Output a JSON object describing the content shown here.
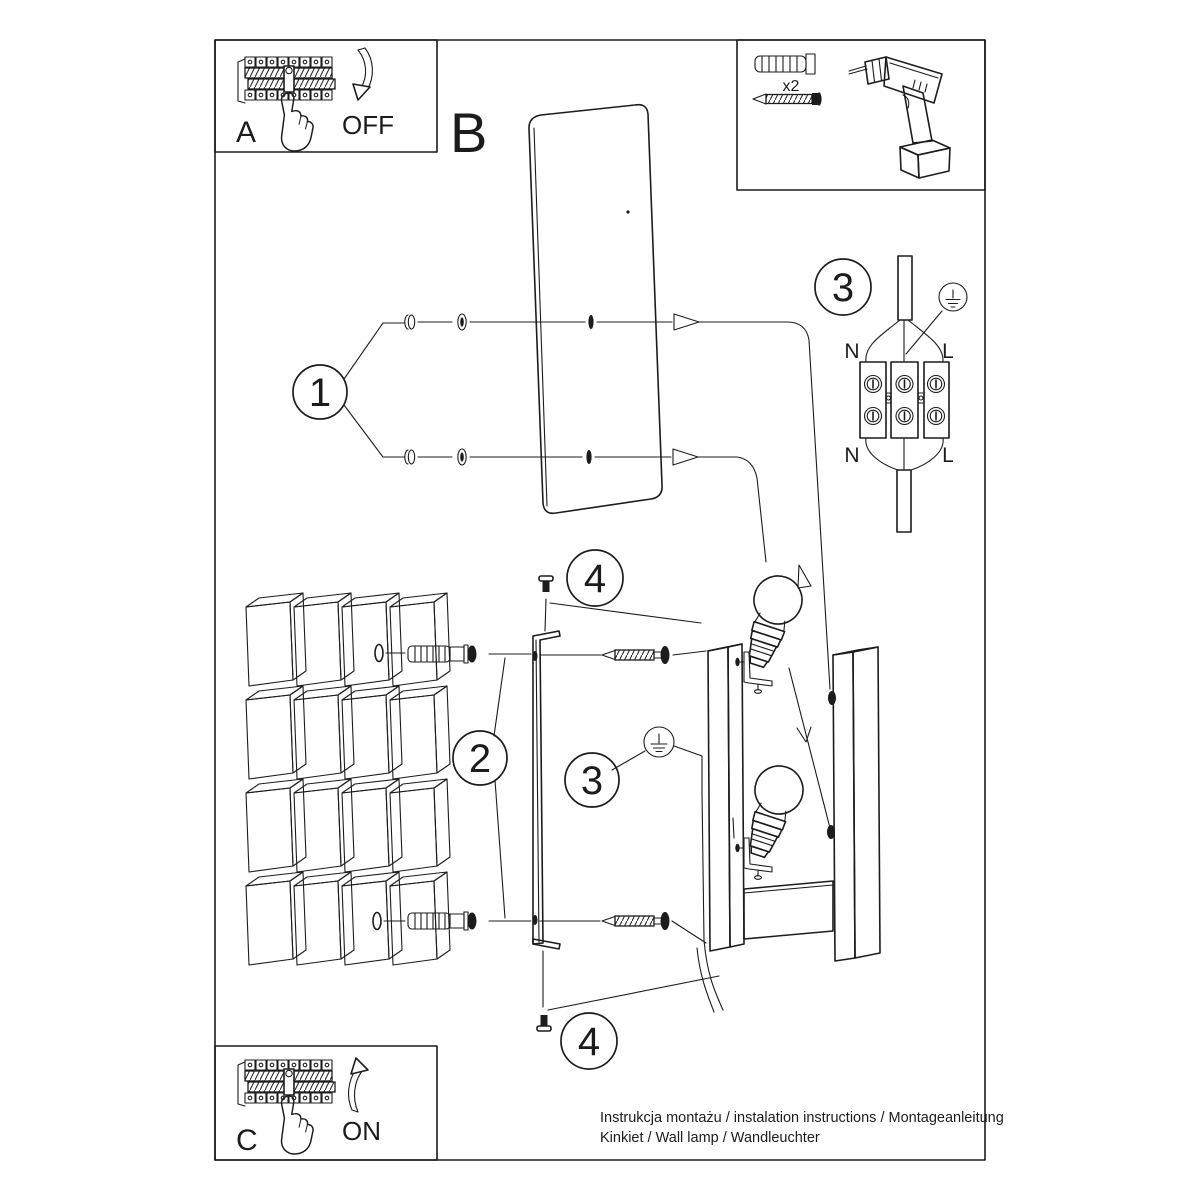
{
  "colors": {
    "line": "#1c1c1c",
    "background": "#ffffff"
  },
  "steps": {
    "one": "1",
    "two": "2",
    "three": "3",
    "four": "4"
  },
  "panel_a": {
    "label": "A",
    "action": "OFF"
  },
  "panel_b": {
    "label": "B"
  },
  "panel_c": {
    "label": "C",
    "action": "ON"
  },
  "tools": {
    "dowel_qty": "x2"
  },
  "wiring": {
    "top_left": "N",
    "top_right": "L",
    "bottom_left": "N",
    "bottom_right": "L"
  },
  "footer": {
    "line1": "Instrukcja montażu / instalation instructions / Montageanleitung",
    "line2": "Kinkiet / Wall lamp / Wandleuchter"
  }
}
